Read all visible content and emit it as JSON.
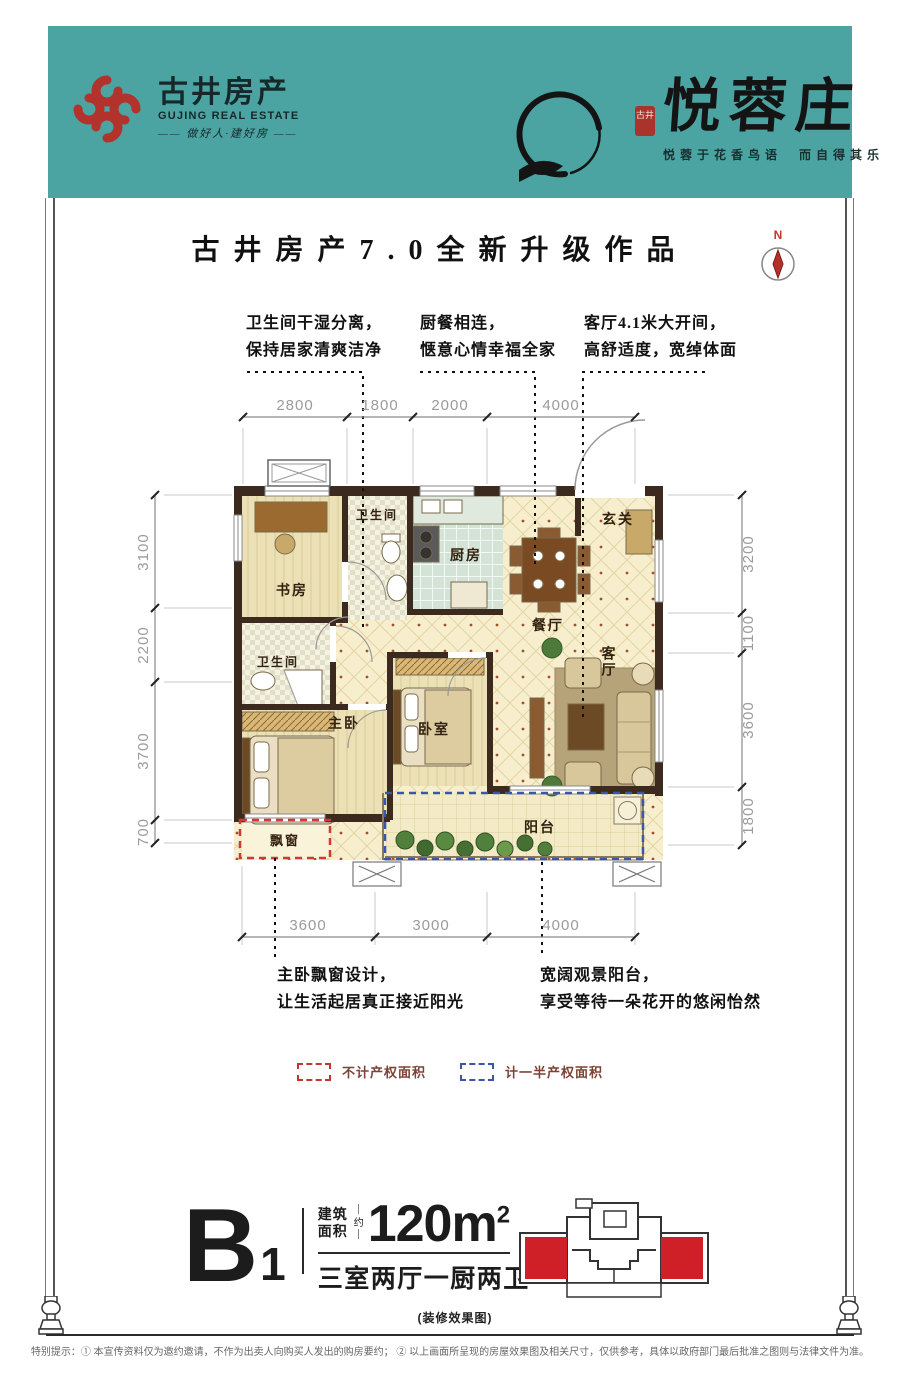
{
  "header": {
    "logo": {
      "cn": "古井房产",
      "en": "GUJING REAL ESTATE",
      "slogan": "—— 做好人·建好房 ——"
    },
    "brand": {
      "seal_text": "古井",
      "name": "悦蓉庄",
      "tagline": "悦蓉于花香鸟语　而自得其乐"
    }
  },
  "title": "古井房产7.0全新升级作品",
  "compass": {
    "label": "N"
  },
  "callouts": {
    "top": [
      {
        "l1": "卫生间干湿分离，",
        "l2": "保持居家清爽洁净"
      },
      {
        "l1": "厨餐相连，",
        "l2": "惬意心情幸福全家"
      },
      {
        "l1": "客厅4.1米大开间，",
        "l2": "高舒适度，宽绰体面"
      }
    ],
    "bottom": [
      {
        "l1": "主卧飘窗设计，",
        "l2": "让生活起居真正接近阳光"
      },
      {
        "l1": "宽阔观景阳台，",
        "l2": "享受等待一朵花开的悠闲怡然"
      }
    ]
  },
  "plan": {
    "rooms": {
      "study": "书房",
      "bath1": "卫生间",
      "kitchen": "厨房",
      "dining": "餐厅",
      "foyer": "玄关",
      "bath2": "卫生间",
      "master": "主卧",
      "bedroom": "卧室",
      "living": "客厅",
      "balcony": "阳台",
      "bay": "飘窗"
    },
    "dims": {
      "top": [
        "2800",
        "1800",
        "2000",
        "4000"
      ],
      "left": [
        "3100",
        "2200",
        "3700",
        "700"
      ],
      "right": [
        "3200",
        "1100",
        "3600",
        "1800"
      ],
      "bottom": [
        "3600",
        "3000",
        "4000"
      ]
    }
  },
  "legend": [
    {
      "label": "不计产权面积",
      "color": "#c0392b"
    },
    {
      "label": "计一半产权面积",
      "color": "#3a57a7"
    }
  ],
  "unit": {
    "code": "B",
    "num": "1",
    "area_l1": "建筑",
    "area_l2": "面积",
    "approx": "约",
    "area": "120m",
    "area_exp": "2",
    "rooms": "三室两厅一厨两卫"
  },
  "caption": "(装修效果图)",
  "footer": "特别提示：① 本宣传资料仅为邀约邀请，不作为出卖人向购买人发出的购房要约；  ② 以上画面所呈现的房屋效果图及相关尺寸，仅供参考，具体以政府部门最后批准之图则与法律文件为准。"
}
